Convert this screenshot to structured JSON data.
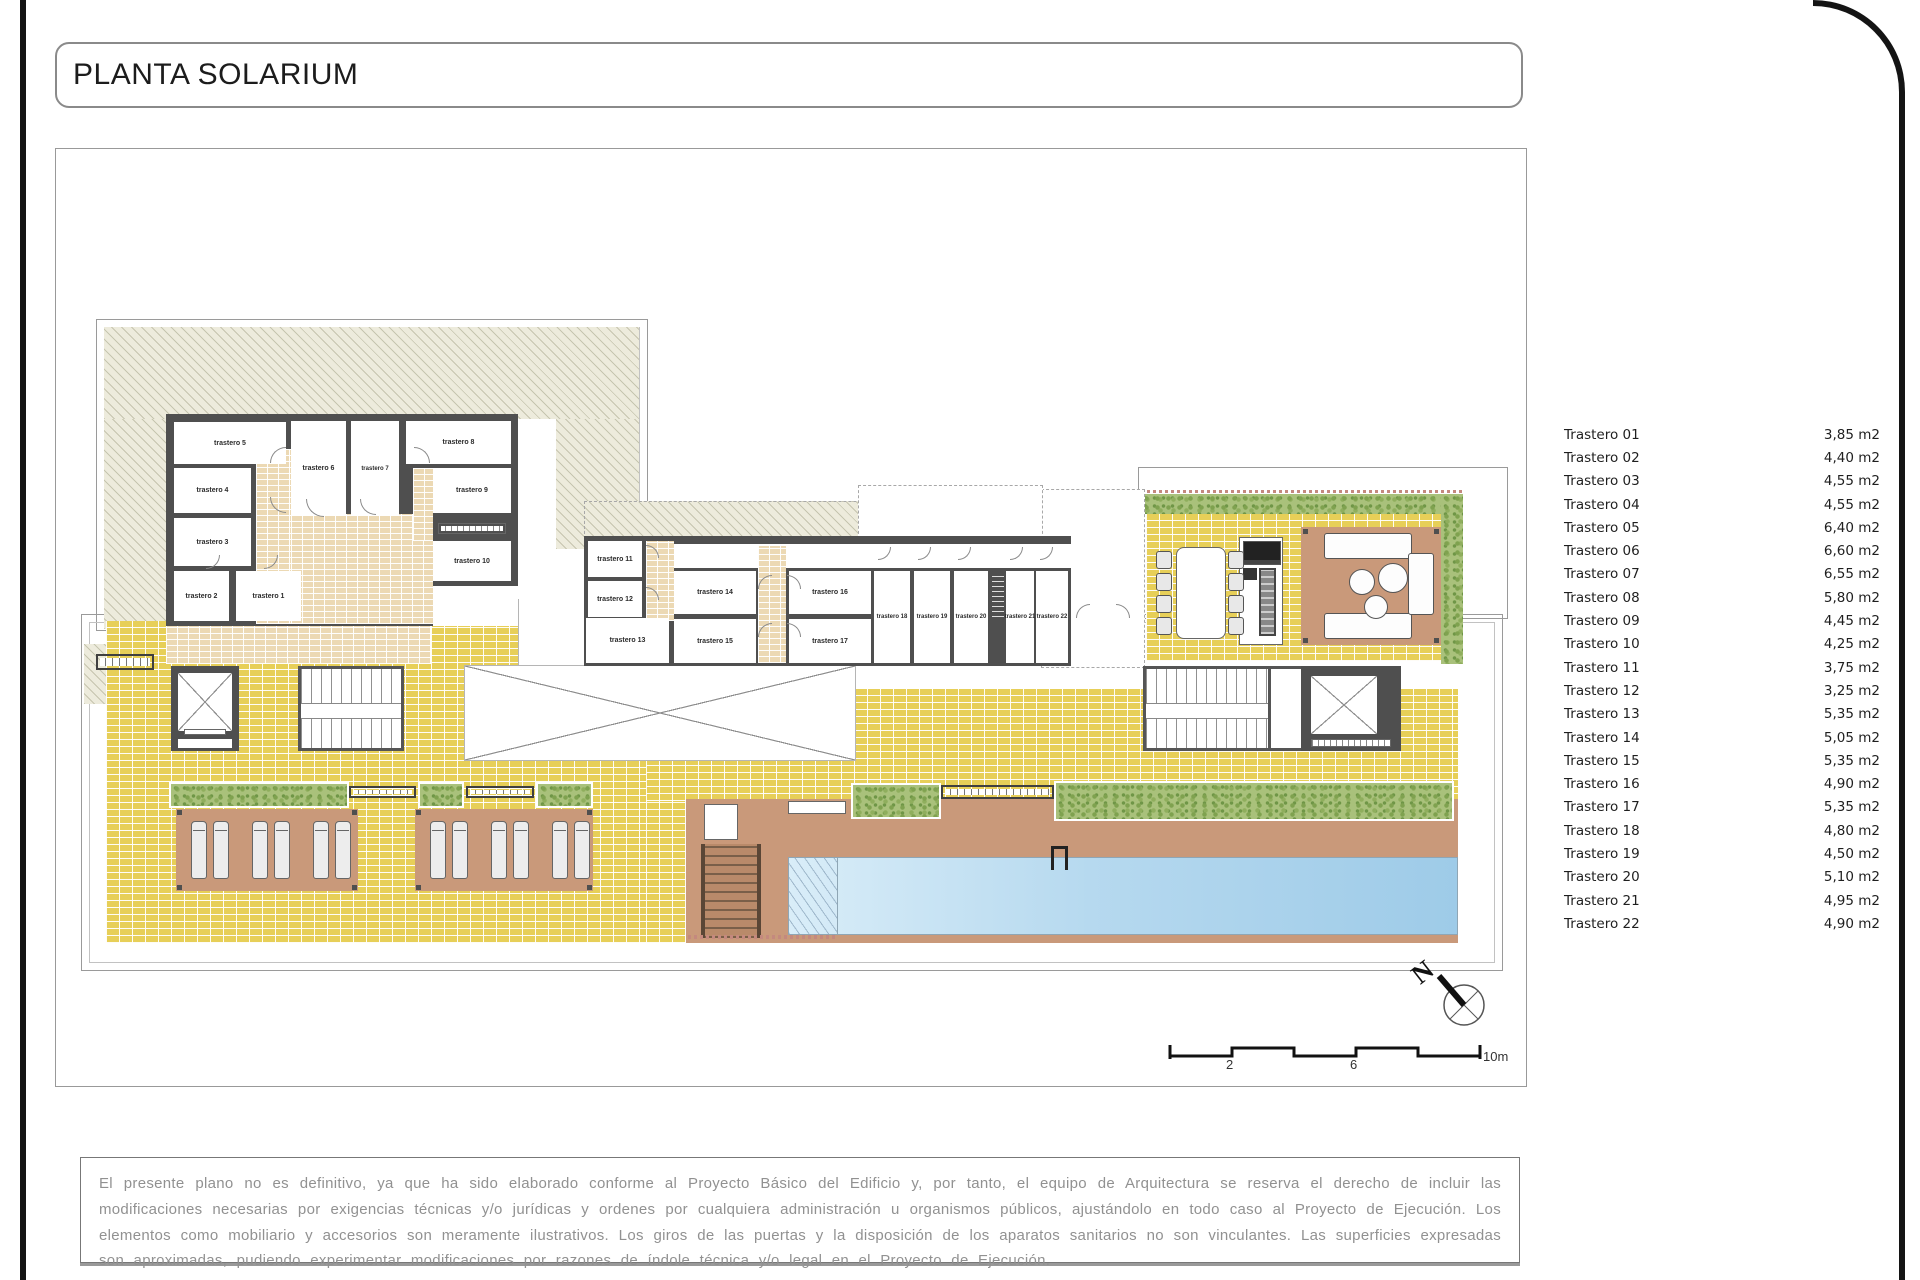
{
  "title": "PLANTA SOLARIUM",
  "storage_list": {
    "items": [
      {
        "label": "Trastero 01",
        "area": "3,85 m2"
      },
      {
        "label": "Trastero 02",
        "area": "4,40 m2"
      },
      {
        "label": "Trastero 03",
        "area": "4,55 m2"
      },
      {
        "label": "Trastero 04",
        "area": "4,55 m2"
      },
      {
        "label": "Trastero 05",
        "area": "6,40 m2"
      },
      {
        "label": "Trastero 06",
        "area": "6,60 m2"
      },
      {
        "label": "Trastero 07",
        "area": "6,55 m2"
      },
      {
        "label": "Trastero 08",
        "area": "5,80 m2"
      },
      {
        "label": "Trastero 09",
        "area": "4,45 m2"
      },
      {
        "label": "Trastero 10",
        "area": "4,25 m2"
      },
      {
        "label": "Trastero 11",
        "area": "3,75 m2"
      },
      {
        "label": "Trastero 12",
        "area": "3,25 m2"
      },
      {
        "label": "Trastero 13",
        "area": "5,35 m2"
      },
      {
        "label": "Trastero 14",
        "area": "5,05 m2"
      },
      {
        "label": "Trastero 15",
        "area": "5,35 m2"
      },
      {
        "label": "Trastero 16",
        "area": "4,90 m2"
      },
      {
        "label": "Trastero 17",
        "area": "5,35 m2"
      },
      {
        "label": "Trastero 18",
        "area": "4,80 m2"
      },
      {
        "label": "Trastero 19",
        "area": "4,50 m2"
      },
      {
        "label": "Trastero 20",
        "area": "5,10 m2"
      },
      {
        "label": "Trastero 21",
        "area": "4,95 m2"
      },
      {
        "label": "Trastero 22",
        "area": "4,90 m2"
      }
    ]
  },
  "plan": {
    "room_labels": [
      "trastero 1",
      "trastero 2",
      "trastero 3",
      "trastero 4",
      "trastero 5",
      "trastero 6",
      "trastero 7",
      "trastero 8",
      "trastero 9",
      "trastero 10",
      "trastero 11",
      "trastero 12",
      "trastero 13",
      "trastero 14",
      "trastero 15",
      "trastero 16",
      "trastero 17",
      "trastero 18",
      "trastero 19",
      "trastero 20",
      "trastero 21",
      "trastero 22"
    ],
    "north_label": "N",
    "scale_labels": [
      "2",
      "6",
      "10m"
    ]
  },
  "disclaimer": "El presente plano no es definitivo, ya que ha sido elaborado conforme al Proyecto Básico del Edificio y, por tanto, el equipo de Arquitectura se reserva el derecho de incluir las modificaciones necesarias por exigencias técnicas y/o jurídicas y ordenes por cualquiera administración u organismos públicos, ajustándolo en todo caso al Proyecto de Ejecución. Los elementos como mobiliario y accesorios son meramente ilustrativos. Los giros de las puertas y la disposición de los aparatos sanitarios no son vinculantes. Las superficies expresadas son aproximadas, pudiendo experimentar modificaciones por razones de índole técnica y/o legal en el Proyecto de Ejecución.",
  "colors": {
    "paving_yellow": "#e7cf58",
    "brick_tan": "#ecd9b4",
    "deck_brown": "#c9997a",
    "hedge_green": "#a9c17b",
    "pool_blue": "#9ecbe8",
    "wall_gray": "#4f4f4f",
    "frame_black": "#141414"
  }
}
